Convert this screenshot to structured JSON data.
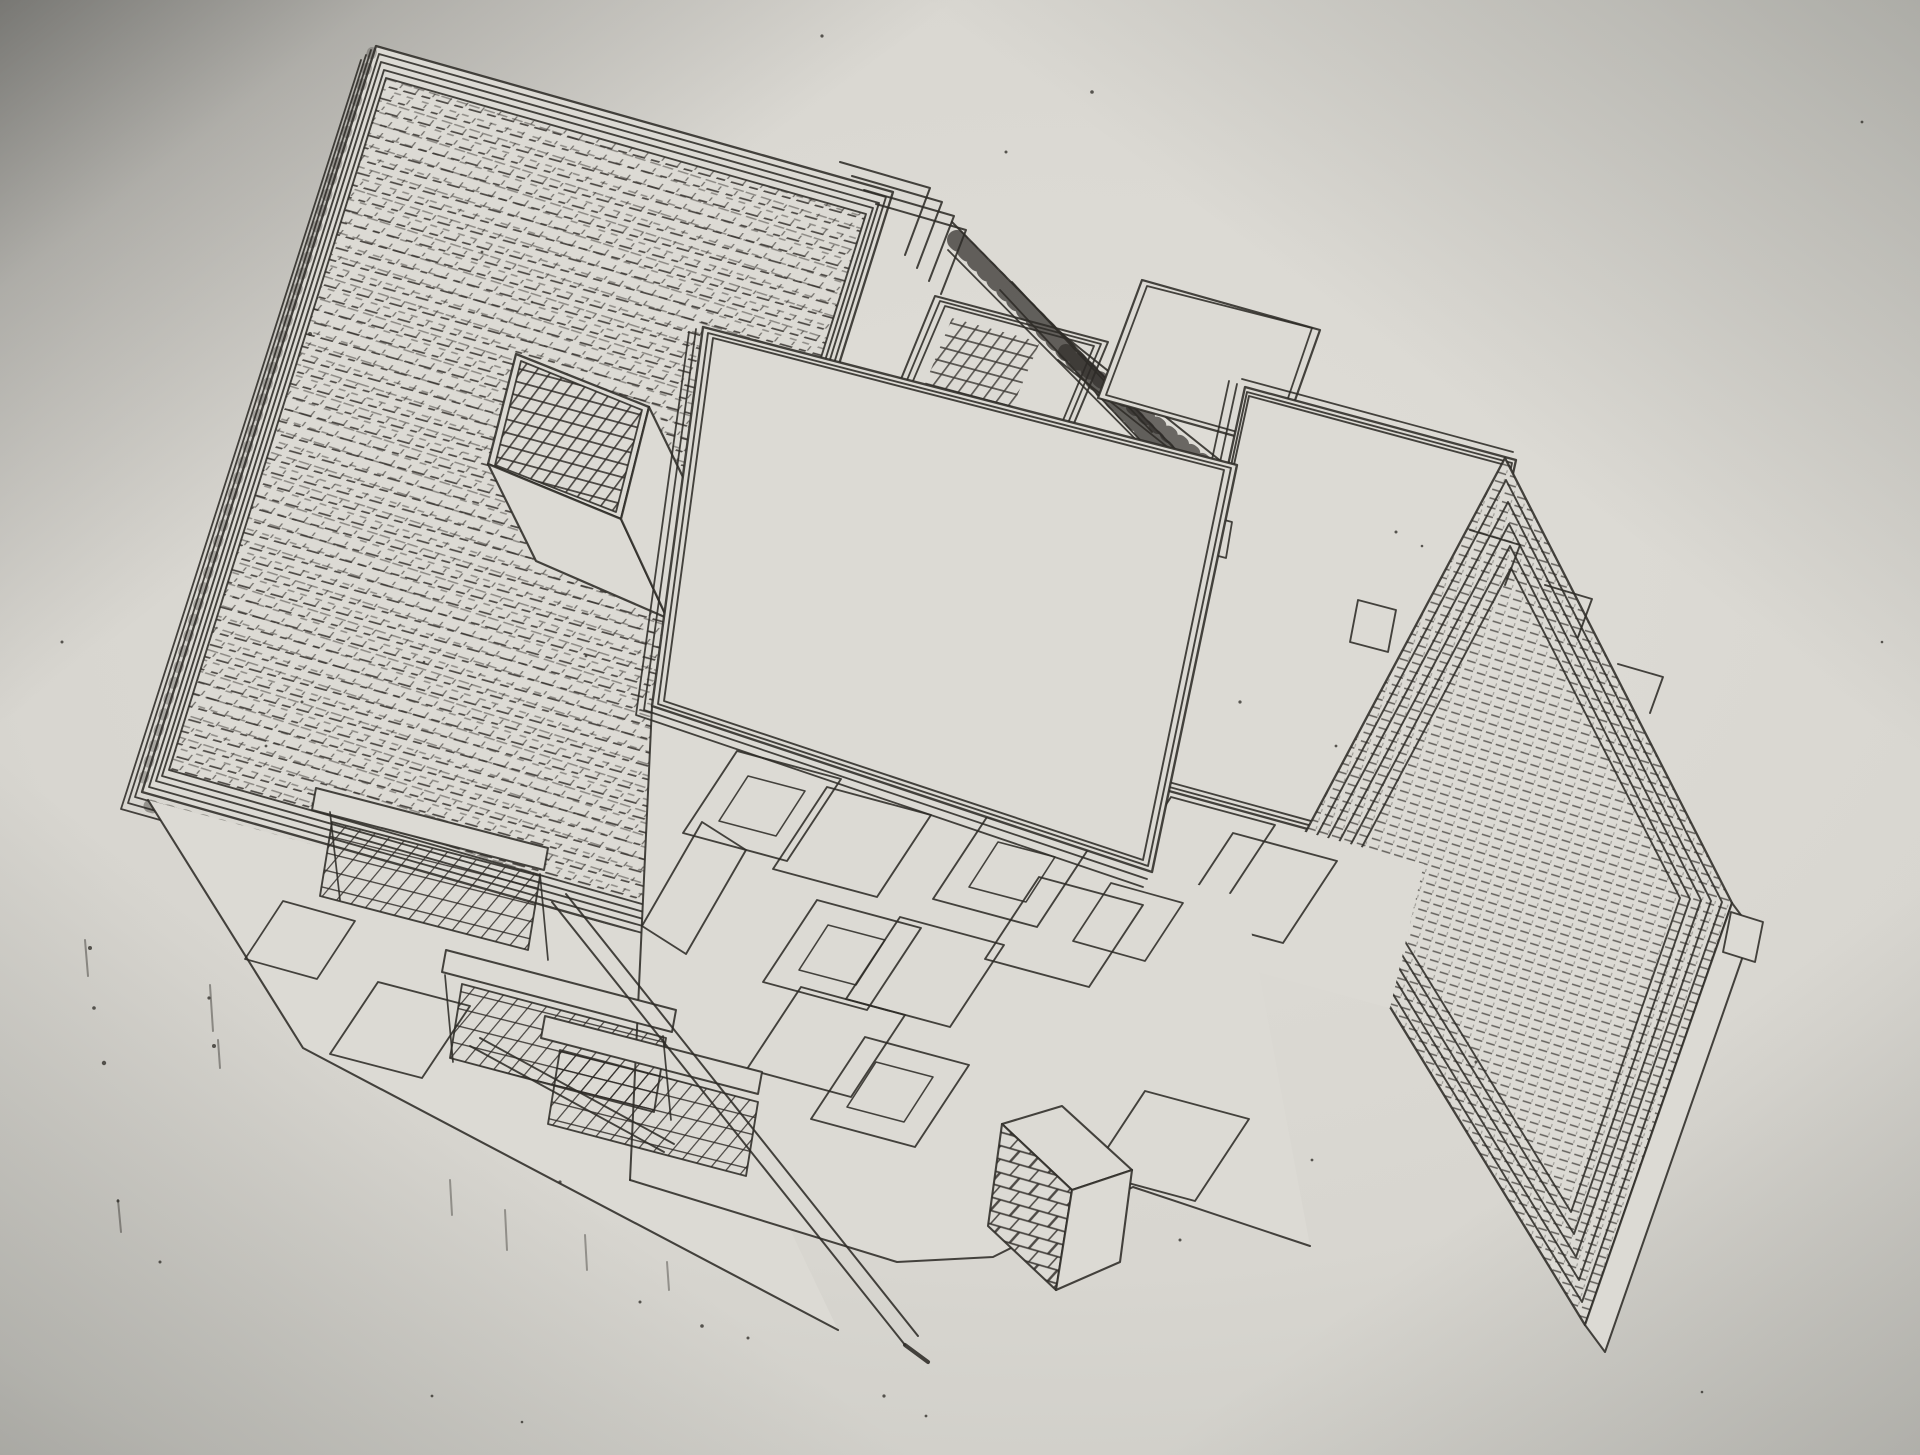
{
  "meta": {
    "description": "Photograph of a black-ink axonometric architectural drawing of a modernist building with stepped roof terraces, a gridded rooftop cube, balconies, stairs and a brick chimney, printed on light gray paper with shadowed corners",
    "image_type": "photo of printed line drawing",
    "visible_text": ""
  },
  "colors": {
    "paper_highlight": "#e0ded8",
    "paper_mid": "#d6d4ce",
    "paper_edge": "#a2a19c",
    "corner_shadow": "#7d7d79",
    "ink": "#2e2b27",
    "white_face": "#dcdad4"
  },
  "drawing": {
    "parts": [
      {
        "name": "roof-west-terrace",
        "kind": "large hatched roof plane with multi-line parapet"
      },
      {
        "name": "rooftop-skylight-cube",
        "kind": "cube with grid-patterned top face"
      },
      {
        "name": "west-facade",
        "kind": "side wall with balcony and windows"
      },
      {
        "name": "upper-terrace",
        "kind": "stepped parapets and stair railings with balusters"
      },
      {
        "name": "terrace-slab-north",
        "kind": "small white roof slab"
      },
      {
        "name": "terrace-slab-east",
        "kind": "white roof slab with triple border"
      },
      {
        "name": "terrace-cascade",
        "kind": "cascade of stepped roof slabs with dashed hatching"
      },
      {
        "name": "east-gap-facade",
        "kind": "wall strip with two parallelogram windows"
      },
      {
        "name": "front-facade",
        "kind": "main facade with parallelogram windows"
      },
      {
        "name": "central-terrace-slab",
        "kind": "large blank roof terrace slab"
      },
      {
        "name": "balcony-stairs",
        "kind": "mesh balcony railings and diagonal exterior stair"
      },
      {
        "name": "brick-chimney",
        "kind": "brick-textured chimney block"
      },
      {
        "name": "ink-specks",
        "kind": "photocopy noise dots and smudges"
      }
    ]
  }
}
